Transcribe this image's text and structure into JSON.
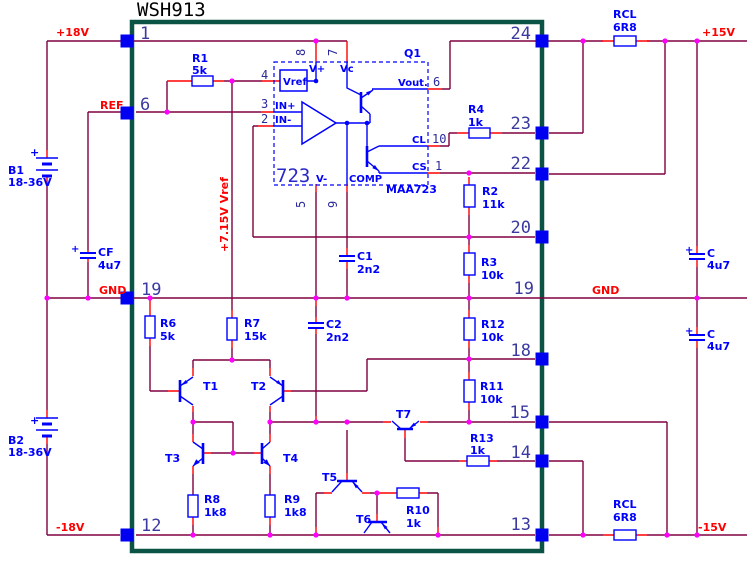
{
  "title": "WSH913",
  "nets": {
    "plus18": "+18V",
    "ref": "REF",
    "gnd_left": "GND",
    "minus18": "-18V",
    "plus15": "+15V",
    "gnd_right": "GND",
    "minus15": "-15V",
    "vref_rail": "+7.15V Vref"
  },
  "pins": {
    "left": {
      "p1": "1",
      "p6": "6",
      "p19": "19",
      "p12": "12"
    },
    "right": {
      "p24": "24",
      "p23": "23",
      "p22": "22",
      "p20": "20",
      "p19": "19",
      "p18": "18",
      "p15": "15",
      "p14": "14",
      "p13": "13"
    }
  },
  "batteries": {
    "b1": {
      "name": "B1",
      "value": "18-36V",
      "plus": "+"
    },
    "b2": {
      "name": "B2",
      "value": "18-36V",
      "plus": "+"
    }
  },
  "resistors": {
    "r1": {
      "name": "R1",
      "value": "5k"
    },
    "r2": {
      "name": "R2",
      "value": "11k"
    },
    "r3": {
      "name": "R3",
      "value": "10k"
    },
    "r4": {
      "name": "R4",
      "value": "1k"
    },
    "r6": {
      "name": "R6",
      "value": "5k"
    },
    "r7": {
      "name": "R7",
      "value": "15k"
    },
    "r8": {
      "name": "R8",
      "value": "1k8"
    },
    "r9": {
      "name": "R9",
      "value": "1k8"
    },
    "r10": {
      "name": "R10",
      "value": "1k"
    },
    "r11": {
      "name": "R11",
      "value": "10k"
    },
    "r12": {
      "name": "R12",
      "value": "10k"
    },
    "r13": {
      "name": "R13",
      "value": "1k"
    },
    "rcl_top": {
      "name": "RCL",
      "value": "6R8"
    },
    "rcl_bottom": {
      "name": "RCL",
      "value": "6R8"
    }
  },
  "capacitors": {
    "cf": {
      "name": "CF",
      "value": "4u7",
      "plus": "+"
    },
    "c1": {
      "name": "C1",
      "value": "2n2"
    },
    "c2": {
      "name": "C2",
      "value": "2n2"
    },
    "c_top": {
      "name": "C",
      "value": "4u7",
      "plus": "+"
    },
    "c_bottom": {
      "name": "C",
      "value": "4u7",
      "plus": "+"
    }
  },
  "transistors": {
    "t1": "T1",
    "t2": "T2",
    "t3": "T3",
    "t4": "T4",
    "t5": "T5",
    "t6": "T6",
    "t7": "T7",
    "q1": "Q1"
  },
  "regulator": {
    "device": "723",
    "part_number": "MAA723",
    "vref_box": "Vref",
    "in_plus": "IN+",
    "in_minus": "IN-",
    "v_plus": "V+",
    "vc": "Vc",
    "vout": "Vout.",
    "cl": "CL",
    "cs": "CS",
    "v_minus": "V-",
    "comp": "COMP",
    "pin_numbers": {
      "p8": "8",
      "p7": "7",
      "p6": "6",
      "p10": "10",
      "p1": "1",
      "p5": "5",
      "p9": "9",
      "p4": "4",
      "p3": "3",
      "p2": "2"
    }
  },
  "colors": {
    "wire": "#800040",
    "stub": "#ff0000",
    "component": "#0000ff",
    "junction": "#ff00ff",
    "chip_border": "#0b5345",
    "net_label": "#ff0000",
    "pin_number": "#3a3aa0"
  }
}
